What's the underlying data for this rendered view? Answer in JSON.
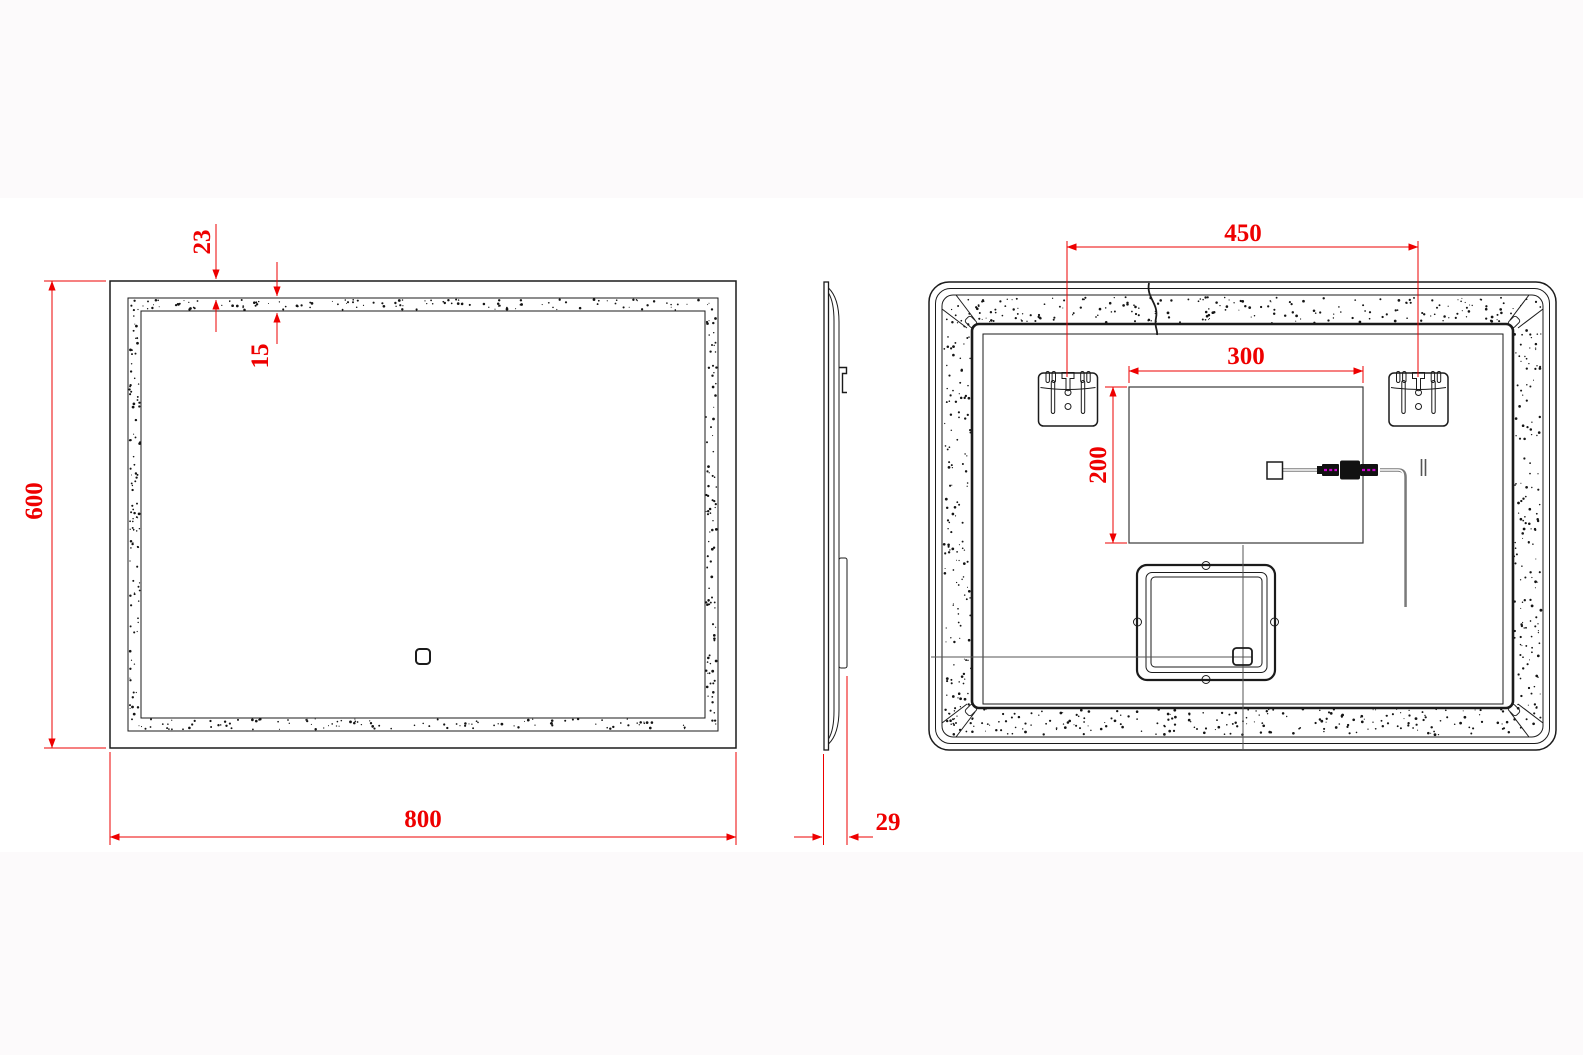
{
  "drawing": {
    "type": "mirror-technical-drawing",
    "dimensions": {
      "front_width": "800",
      "front_height": "600",
      "edge_to_band": "23",
      "band_width": "15",
      "depth": "29",
      "bracket_spacing": "450",
      "cutout_width": "300",
      "cutout_height": "200"
    },
    "colors": {
      "dimension_red": "#ee0000",
      "line_black": "#1b1b1b",
      "cable_gray": "#7a7a7a",
      "connector_magenta": "#cc00cc",
      "sheet_white": "#ffffff",
      "margin_gray": "#fcfafb"
    }
  }
}
